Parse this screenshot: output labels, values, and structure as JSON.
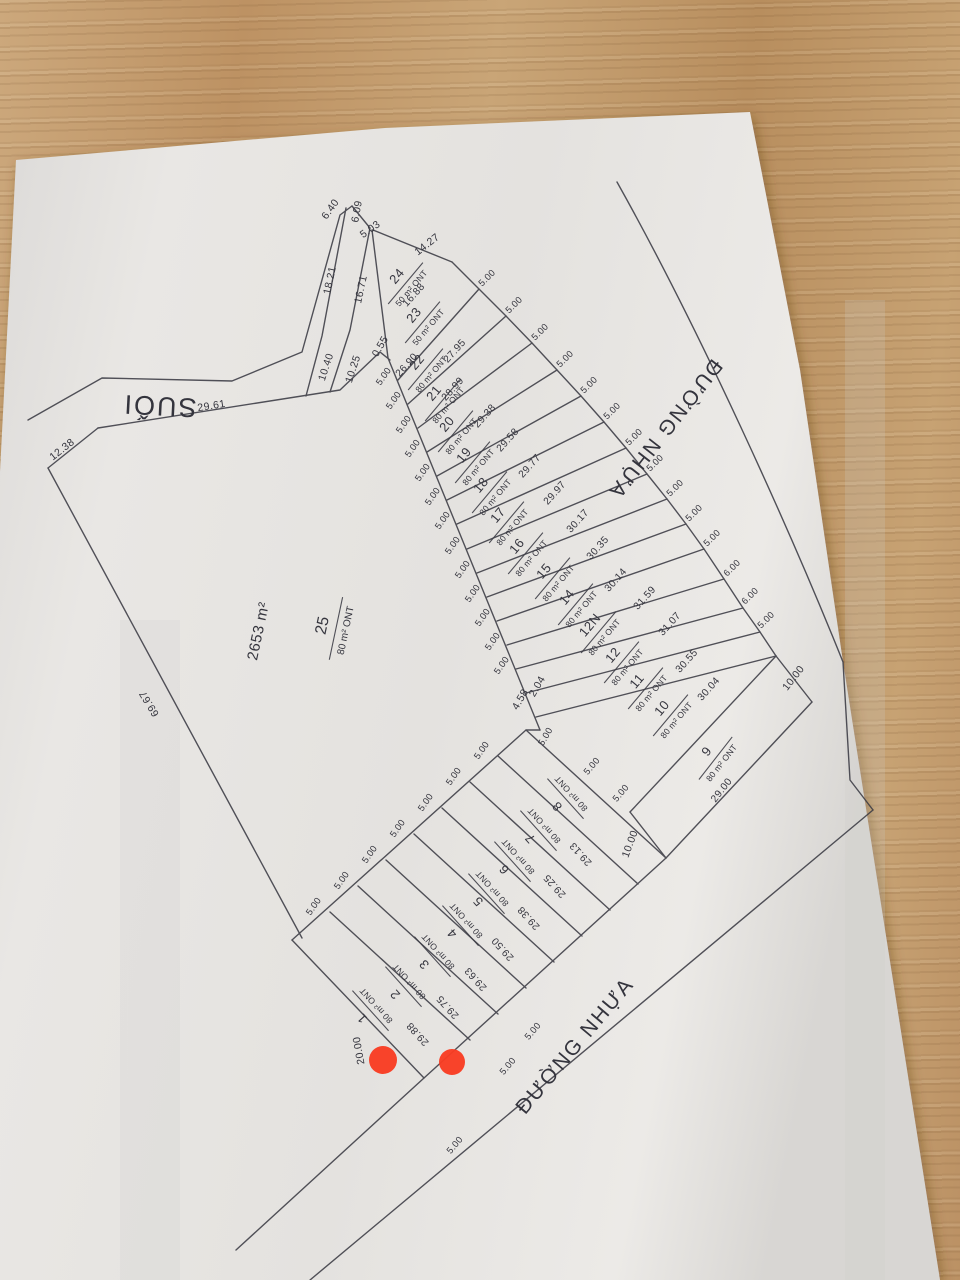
{
  "palette": {
    "wood": "#c29a6a",
    "paper": "#e7e5e2",
    "ink": "#3b3b44",
    "marker": "#f93c22"
  },
  "plan": {
    "stream_label": {
      "text": "SUỐI",
      "x": 160,
      "y": 397,
      "rot": 183
    },
    "street_labels": [
      {
        "text": "ĐƯỜNG NHỰA",
        "x": 660,
        "y": 425,
        "rot": 128
      },
      {
        "text": "ĐƯỜNG NHỰA",
        "x": 580,
        "y": 1050,
        "rot": -50
      }
    ],
    "remainder_parcel_area": {
      "text": "2653 m²",
      "x": 263,
      "y": 632,
      "rot": -78
    },
    "lots": [
      {
        "no": "24",
        "area": "50 m² ONT",
        "x": 404,
        "y": 282,
        "rot": -50
      },
      {
        "no": "23",
        "area": "50 m² ONT",
        "x": 421,
        "y": 321,
        "rot": -50
      },
      {
        "no": "22",
        "area": "80 m² ONT",
        "x": 424,
        "y": 368,
        "rot": -50
      },
      {
        "no": "21",
        "area": "80 m² ONT",
        "x": 441,
        "y": 399,
        "rot": -50
      },
      {
        "no": "20",
        "area": "80 m² ONT",
        "x": 454,
        "y": 430,
        "rot": -50
      },
      {
        "no": "19",
        "area": "80 m² ONT",
        "x": 471,
        "y": 461,
        "rot": -50
      },
      {
        "no": "18",
        "area": "80 m² ONT",
        "x": 488,
        "y": 491,
        "rot": -50
      },
      {
        "no": "17",
        "area": "80 m² ONT",
        "x": 505,
        "y": 521,
        "rot": -50
      },
      {
        "no": "16",
        "area": "80 m² ONT",
        "x": 524,
        "y": 552,
        "rot": -50
      },
      {
        "no": "15",
        "area": "80 m² ONT",
        "x": 551,
        "y": 577,
        "rot": -50
      },
      {
        "no": "14",
        "area": "80 m² ONT",
        "x": 574,
        "y": 603,
        "rot": -50
      },
      {
        "no": "12N",
        "area": "80 m² ONT",
        "x": 597,
        "y": 631,
        "rot": -50
      },
      {
        "no": "12",
        "area": "80 m² ONT",
        "x": 620,
        "y": 661,
        "rot": -50
      },
      {
        "no": "11",
        "area": "80 m² ONT",
        "x": 644,
        "y": 687,
        "rot": -50
      },
      {
        "no": "10",
        "area": "80 m² ONT",
        "x": 669,
        "y": 714,
        "rot": -50
      },
      {
        "no": "9",
        "area": "80 m² ONT",
        "x": 714,
        "y": 757,
        "rot": -52
      },
      {
        "no": "8",
        "area": "80 m² ONT",
        "x": 564,
        "y": 800,
        "rot": -132
      },
      {
        "no": "7",
        "area": "80 m² ONT",
        "x": 537,
        "y": 832,
        "rot": -132
      },
      {
        "no": "6",
        "area": "80 m² ONT",
        "x": 511,
        "y": 863,
        "rot": -132
      },
      {
        "no": "5",
        "area": "80 m² ONT",
        "x": 485,
        "y": 895,
        "rot": -132
      },
      {
        "no": "4",
        "area": "80 m² ONT",
        "x": 459,
        "y": 927,
        "rot": -132
      },
      {
        "no": "3",
        "area": "80 m² ONT",
        "x": 431,
        "y": 958,
        "rot": -132
      },
      {
        "no": "2",
        "area": "80 m² ONT",
        "x": 402,
        "y": 988,
        "rot": -132
      },
      {
        "no": "1",
        "area": "80 m² ONT",
        "x": 369,
        "y": 1012,
        "rot": -132
      },
      {
        "no": "25",
        "area": "80 m² ONT",
        "x": 334,
        "y": 628,
        "rot": -78,
        "big": true
      }
    ],
    "dimensions": [
      {
        "text": "16.88",
        "x": 416,
        "y": 297,
        "rot": -48
      },
      {
        "text": "26.90",
        "x": 409,
        "y": 367,
        "rot": -48
      },
      {
        "text": "27.95",
        "x": 457,
        "y": 353,
        "rot": -48
      },
      {
        "text": "28.99",
        "x": 455,
        "y": 391,
        "rot": -48
      },
      {
        "text": "29.38",
        "x": 487,
        "y": 418,
        "rot": -48
      },
      {
        "text": "29.58",
        "x": 510,
        "y": 442,
        "rot": -48
      },
      {
        "text": "29.77",
        "x": 532,
        "y": 468,
        "rot": -48
      },
      {
        "text": "29.97",
        "x": 557,
        "y": 495,
        "rot": -48
      },
      {
        "text": "30.17",
        "x": 580,
        "y": 523,
        "rot": -48
      },
      {
        "text": "30.35",
        "x": 600,
        "y": 550,
        "rot": -48
      },
      {
        "text": "30.14",
        "x": 618,
        "y": 582,
        "rot": -48
      },
      {
        "text": "31.59",
        "x": 647,
        "y": 600,
        "rot": -48
      },
      {
        "text": "31.07",
        "x": 672,
        "y": 626,
        "rot": -48
      },
      {
        "text": "30.55",
        "x": 689,
        "y": 663,
        "rot": -48
      },
      {
        "text": "30.04",
        "x": 711,
        "y": 691,
        "rot": -48
      },
      {
        "text": "29.00",
        "x": 724,
        "y": 792,
        "rot": -52
      },
      {
        "text": "29.13",
        "x": 583,
        "y": 852,
        "rot": -132
      },
      {
        "text": "29.25",
        "x": 557,
        "y": 884,
        "rot": -132
      },
      {
        "text": "29.38",
        "x": 531,
        "y": 916,
        "rot": -132
      },
      {
        "text": "29.50",
        "x": 505,
        "y": 947,
        "rot": -132
      },
      {
        "text": "29.63",
        "x": 478,
        "y": 977,
        "rot": -132
      },
      {
        "text": "29.75",
        "x": 450,
        "y": 1005,
        "rot": -132
      },
      {
        "text": "29.88",
        "x": 420,
        "y": 1032,
        "rot": -132
      }
    ],
    "boundary_measures": [
      {
        "text": "6.40",
        "x": 333,
        "y": 211,
        "rot": -55
      },
      {
        "text": "6.09",
        "x": 360,
        "y": 212,
        "rot": -80
      },
      {
        "text": "5.03",
        "x": 372,
        "y": 232,
        "rot": -35
      },
      {
        "text": "14.27",
        "x": 429,
        "y": 247,
        "rot": -38
      },
      {
        "text": "18.21",
        "x": 333,
        "y": 281,
        "rot": -78
      },
      {
        "text": "16.71",
        "x": 364,
        "y": 290,
        "rot": -78
      },
      {
        "text": "10.40",
        "x": 329,
        "y": 368,
        "rot": -72
      },
      {
        "text": "10.25",
        "x": 356,
        "y": 370,
        "rot": -72
      },
      {
        "text": "0.55",
        "x": 383,
        "y": 348,
        "rot": -60
      },
      {
        "text": "29.61",
        "x": 212,
        "y": 409,
        "rot": -9
      },
      {
        "text": "12.38",
        "x": 64,
        "y": 452,
        "rot": -38
      },
      {
        "text": "69.67",
        "x": 152,
        "y": 702,
        "rot": -121
      },
      {
        "text": "20.00",
        "x": 362,
        "y": 1050,
        "rot": -100
      },
      {
        "text": "10.00",
        "x": 796,
        "y": 680,
        "rot": -52
      },
      {
        "text": "10.00",
        "x": 633,
        "y": 845,
        "rot": -70
      },
      {
        "text": "2.04",
        "x": 540,
        "y": 688,
        "rot": -60
      },
      {
        "text": "4.58",
        "x": 523,
        "y": 701,
        "rot": -60
      }
    ],
    "frontage_ticks": [
      {
        "text": "5.00",
        "x": 489,
        "y": 280,
        "rot": -45
      },
      {
        "text": "5.00",
        "x": 516,
        "y": 307,
        "rot": -45
      },
      {
        "text": "5.00",
        "x": 542,
        "y": 334,
        "rot": -45
      },
      {
        "text": "5.00",
        "x": 567,
        "y": 361,
        "rot": -45
      },
      {
        "text": "5.00",
        "x": 591,
        "y": 387,
        "rot": -45
      },
      {
        "text": "5.00",
        "x": 614,
        "y": 413,
        "rot": -45
      },
      {
        "text": "5.00",
        "x": 636,
        "y": 439,
        "rot": -45
      },
      {
        "text": "5.00",
        "x": 657,
        "y": 465,
        "rot": -45
      },
      {
        "text": "5.00",
        "x": 677,
        "y": 490,
        "rot": -45
      },
      {
        "text": "5.00",
        "x": 696,
        "y": 515,
        "rot": -45
      },
      {
        "text": "5.00",
        "x": 714,
        "y": 540,
        "rot": -45
      },
      {
        "text": "6.00",
        "x": 734,
        "y": 570,
        "rot": -45
      },
      {
        "text": "6.00",
        "x": 752,
        "y": 598,
        "rot": -45
      },
      {
        "text": "5.00",
        "x": 768,
        "y": 622,
        "rot": -45
      },
      {
        "text": "5.00",
        "x": 594,
        "y": 768,
        "rot": -50
      },
      {
        "text": "5.00",
        "x": 623,
        "y": 795,
        "rot": -50
      },
      {
        "text": "5.00",
        "x": 386,
        "y": 378,
        "rot": -55
      },
      {
        "text": "5.00",
        "x": 396,
        "y": 402,
        "rot": -55
      },
      {
        "text": "5.00",
        "x": 406,
        "y": 426,
        "rot": -55
      },
      {
        "text": "5.00",
        "x": 415,
        "y": 450,
        "rot": -55
      },
      {
        "text": "5.00",
        "x": 425,
        "y": 474,
        "rot": -55
      },
      {
        "text": "5.00",
        "x": 435,
        "y": 498,
        "rot": -55
      },
      {
        "text": "5.00",
        "x": 445,
        "y": 522,
        "rot": -55
      },
      {
        "text": "5.00",
        "x": 455,
        "y": 547,
        "rot": -55
      },
      {
        "text": "5.00",
        "x": 465,
        "y": 571,
        "rot": -55
      },
      {
        "text": "5.00",
        "x": 475,
        "y": 595,
        "rot": -55
      },
      {
        "text": "5.00",
        "x": 485,
        "y": 619,
        "rot": -55
      },
      {
        "text": "5.00",
        "x": 495,
        "y": 643,
        "rot": -55
      },
      {
        "text": "5.00",
        "x": 504,
        "y": 667,
        "rot": -55
      },
      {
        "text": "5.00",
        "x": 548,
        "y": 738,
        "rot": -60
      },
      {
        "text": "5.00",
        "x": 484,
        "y": 752,
        "rot": -55
      },
      {
        "text": "5.00",
        "x": 456,
        "y": 778,
        "rot": -55
      },
      {
        "text": "5.00",
        "x": 428,
        "y": 804,
        "rot": -55
      },
      {
        "text": "5.00",
        "x": 400,
        "y": 830,
        "rot": -55
      },
      {
        "text": "5.00",
        "x": 372,
        "y": 856,
        "rot": -55
      },
      {
        "text": "5.00",
        "x": 344,
        "y": 882,
        "rot": -55
      },
      {
        "text": "5.00",
        "x": 316,
        "y": 908,
        "rot": -55
      },
      {
        "text": "5.00",
        "x": 535,
        "y": 1033,
        "rot": -50
      },
      {
        "text": "5.00",
        "x": 510,
        "y": 1068,
        "rot": -50
      },
      {
        "text": "5.00",
        "x": 457,
        "y": 1147,
        "rot": -50
      }
    ],
    "markers": [
      {
        "x": 383,
        "y": 1060,
        "r": 14
      },
      {
        "x": 452,
        "y": 1062,
        "r": 13
      }
    ]
  }
}
